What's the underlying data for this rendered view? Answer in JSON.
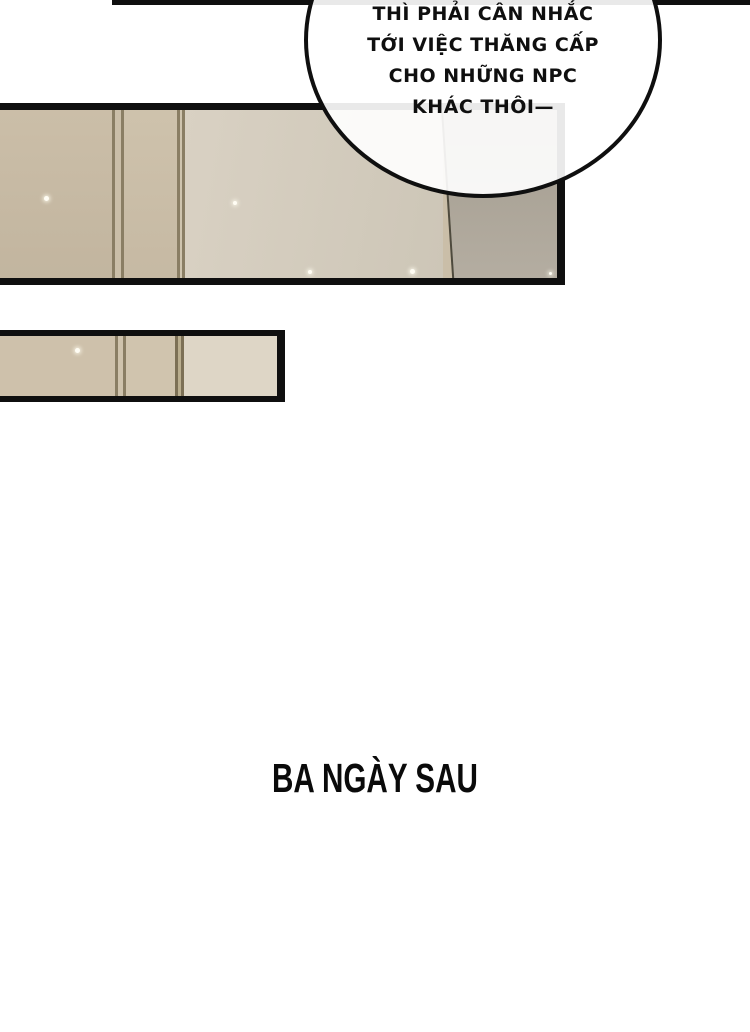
{
  "comic": {
    "background": "#ffffff",
    "ink": "#0f0f0f"
  },
  "speech_bubble": {
    "fill": "#ffffff",
    "stroke": "#0f0f0f",
    "lines": [
      "THÌ PHẢI CÂN NHẮC",
      "TỚI VIỆC THĂNG CẤP",
      "CHO NHỮNG NPC",
      "KHÁC THÔI—"
    ]
  },
  "caption": {
    "text": "BA NGÀY SAU",
    "color": "#0a0a0a"
  },
  "palette": {
    "panel_tan": "#c7baa4",
    "panel_tan_mid": "#ccc0aa",
    "panel_beige_light": "#d9d1c3",
    "panel_gray_right": "#aea79b",
    "panel_seam_line": "#8a7e64",
    "panel2_light_section": "#ded6c6",
    "diagonal_line": "#4e4a3d"
  }
}
